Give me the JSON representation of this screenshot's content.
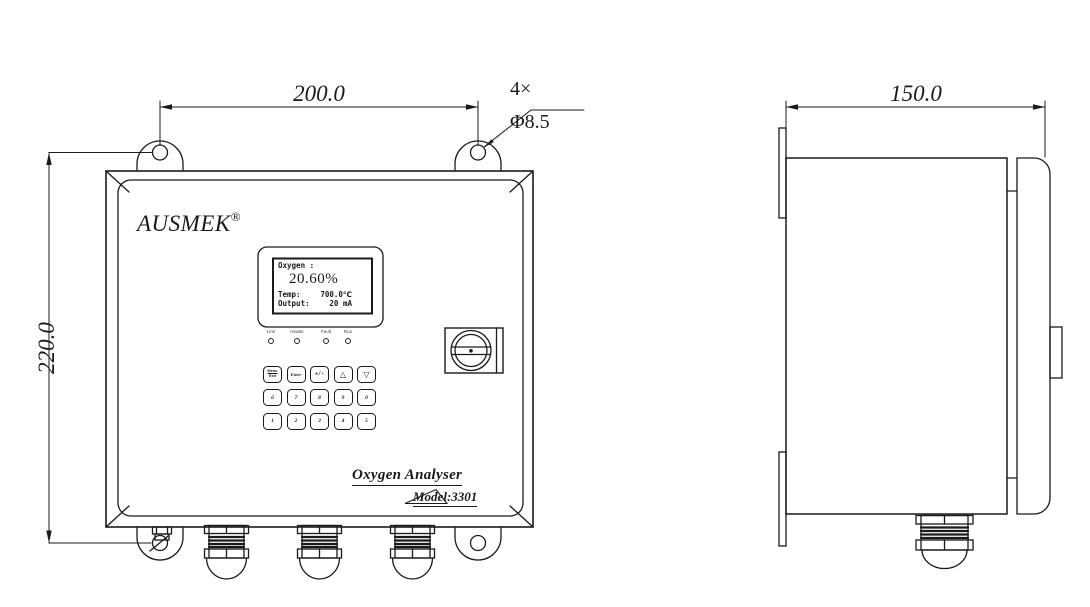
{
  "brand": {
    "name": "AUSMEK",
    "registered": "®"
  },
  "product": {
    "name": "Oxygen Analyser",
    "model": "Model:3301"
  },
  "dimensions": {
    "mounting_width": "200.0",
    "body_height": "220.0",
    "body_depth": "150.0",
    "hole_count": "4×",
    "hole_diameter": "Φ8.5"
  },
  "display": {
    "oxygen_label": "Oxygen :",
    "oxygen_value": "20.60%",
    "temp_label": "Temp:",
    "temp_value": "700.0℃",
    "output_label": "Output:",
    "output_value": "20 mA"
  },
  "leds": [
    {
      "label": "Link"
    },
    {
      "label": "Heater"
    },
    {
      "label": "Fault"
    },
    {
      "label": "Run"
    }
  ],
  "keypad": {
    "menu_label": "Menu",
    "exit_label": "Exit",
    "enter_label": "Enter",
    "sign_label": "+/-",
    "up_label": "△",
    "down_label": "▽",
    "digits_row2": [
      "6",
      "7",
      "8",
      "9",
      "0"
    ],
    "digits_row3": [
      "1",
      "2",
      "3",
      "4",
      "5"
    ]
  },
  "line_color": "#1a1a1a"
}
